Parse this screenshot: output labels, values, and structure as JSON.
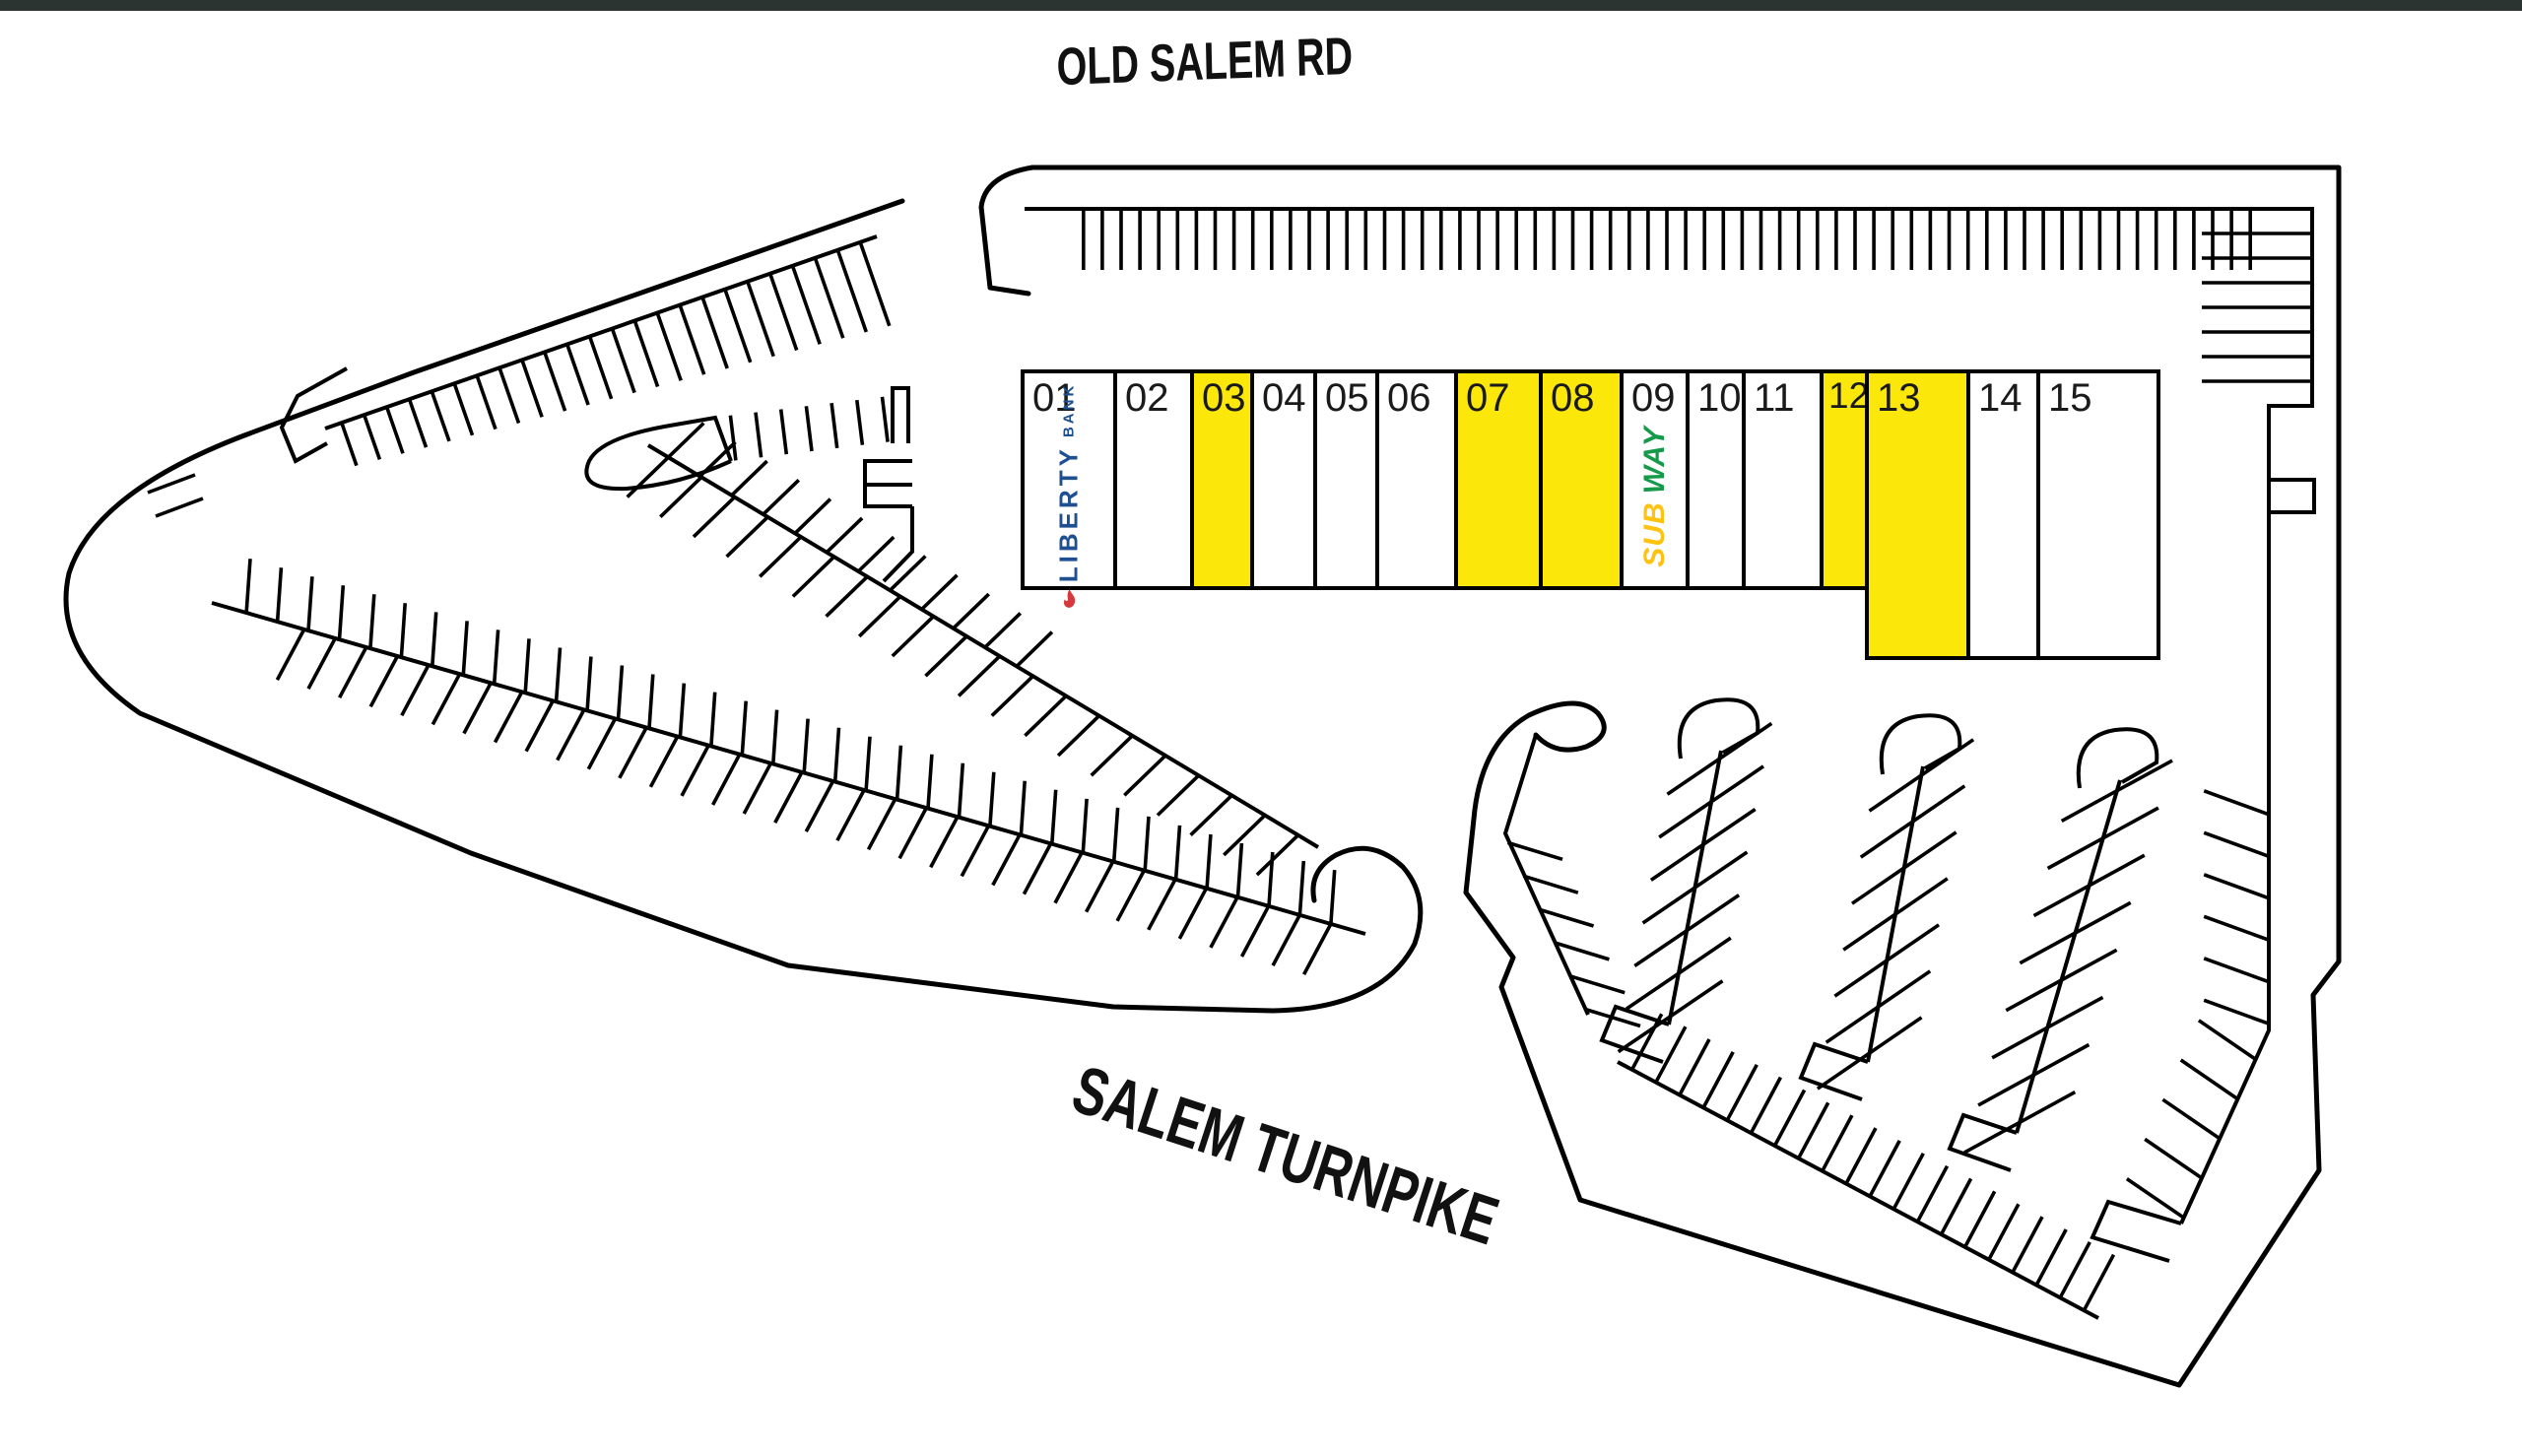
{
  "roads": {
    "top": "OLD SALEM RD",
    "bottom": "SALEM TURNPIKE"
  },
  "building": {
    "units": [
      {
        "label": "01",
        "highlighted": false,
        "logo": "liberty"
      },
      {
        "label": "02",
        "highlighted": false
      },
      {
        "label": "03",
        "highlighted": true
      },
      {
        "label": "04",
        "highlighted": false
      },
      {
        "label": "05",
        "highlighted": false
      },
      {
        "label": "06",
        "highlighted": false
      },
      {
        "label": "07",
        "highlighted": true
      },
      {
        "label": "08",
        "highlighted": true
      },
      {
        "label": "09",
        "highlighted": false,
        "logo": "subway"
      },
      {
        "label": "10",
        "highlighted": false
      },
      {
        "label": "11",
        "highlighted": false
      },
      {
        "label": "12",
        "highlighted": true
      },
      {
        "label": "13",
        "highlighted": true
      },
      {
        "label": "14",
        "highlighted": false
      },
      {
        "label": "15",
        "highlighted": false
      }
    ]
  },
  "logos": {
    "liberty": {
      "name": "LIBERTY",
      "suffix": "BANK",
      "blue": "#1d4f91",
      "red": "#d6383c"
    },
    "subway": {
      "part1": "SUB",
      "part2": "WAY",
      "yellow": "#ffc20e",
      "green": "#149a49"
    }
  },
  "colors": {
    "highlight": "#fbe70a",
    "line": "#000000",
    "label": "#1a1a1a",
    "topbar": "#2c3431"
  }
}
